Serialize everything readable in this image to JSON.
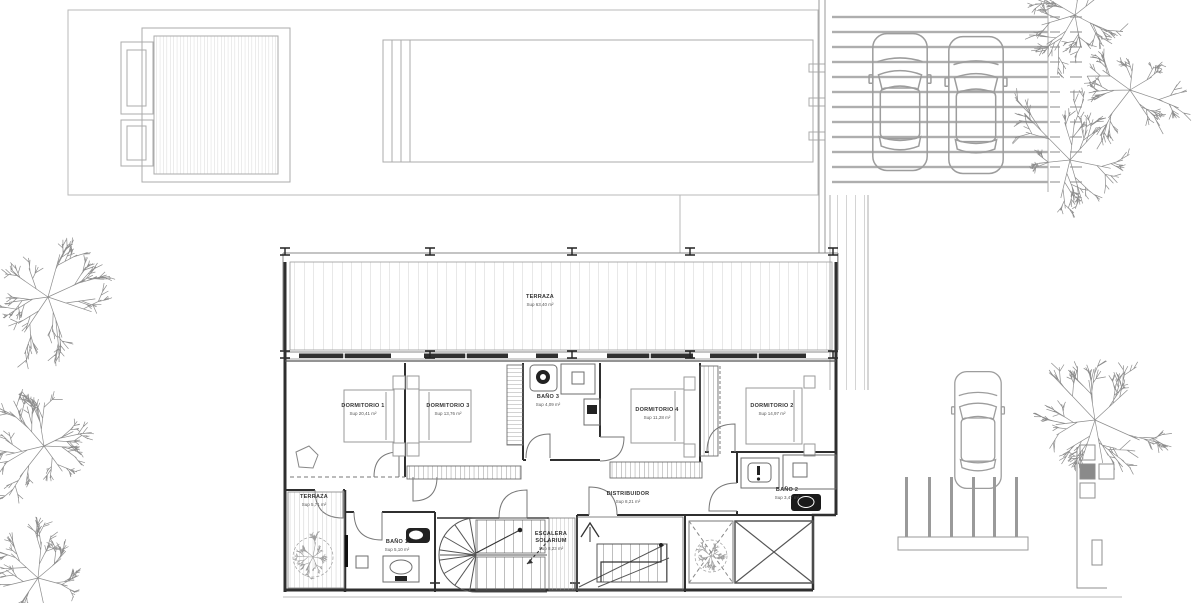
{
  "document": {
    "type": "architectural-floor-plan",
    "style": "CAD line drawing, plan view",
    "paper_color": "#ffffff"
  },
  "colors": {
    "walls": "#2f2f2f",
    "interior_lines": "#6e6e6e",
    "furniture_lines": "#9a9a9a",
    "site_lines": "#b9b9b9",
    "hatch": "#c6c6c6",
    "fixture_dark": "#1a1a1a"
  },
  "rooms": [
    {
      "id": "terraza-upper",
      "name": "TERRAZA",
      "area": "Sup 63,40 m²"
    },
    {
      "id": "dormitorio-1",
      "name": "DORMITORIO 1",
      "area": "Sup 20,41 m²"
    },
    {
      "id": "dormitorio-3",
      "name": "DORMITORIO 3",
      "area": "Sup 13,76 m²"
    },
    {
      "id": "bano-3",
      "name": "BAÑO 3",
      "area": "Sup 4,09 m²"
    },
    {
      "id": "dormitorio-4",
      "name": "DORMITORIO 4",
      "area": "Sup 11,28 m²"
    },
    {
      "id": "dormitorio-2",
      "name": "DORMITORIO 2",
      "area": "Sup 14,97 m²"
    },
    {
      "id": "distribuidor",
      "name": "DISTRIBUIDOR",
      "area": "Sup 8,21 m²"
    },
    {
      "id": "terraza-lower",
      "name": "TERRAZA",
      "area": "Sup 5,71 m²"
    },
    {
      "id": "bano-1",
      "name": "BAÑO 1",
      "area": "Sup 5,10 m²"
    },
    {
      "id": "escalera-solarium",
      "name": "ESCALERA SOLARIUM",
      "area": "Sup 8,23 m²"
    },
    {
      "id": "bano-2",
      "name": "BAÑO 2",
      "area": "Sup 3,47 m²"
    }
  ],
  "site_features": [
    "solarium-deck",
    "swimming-pool",
    "pergola-carport",
    "parked-cars",
    "garden-trees",
    "boundary-fence",
    "stair-skylight"
  ]
}
